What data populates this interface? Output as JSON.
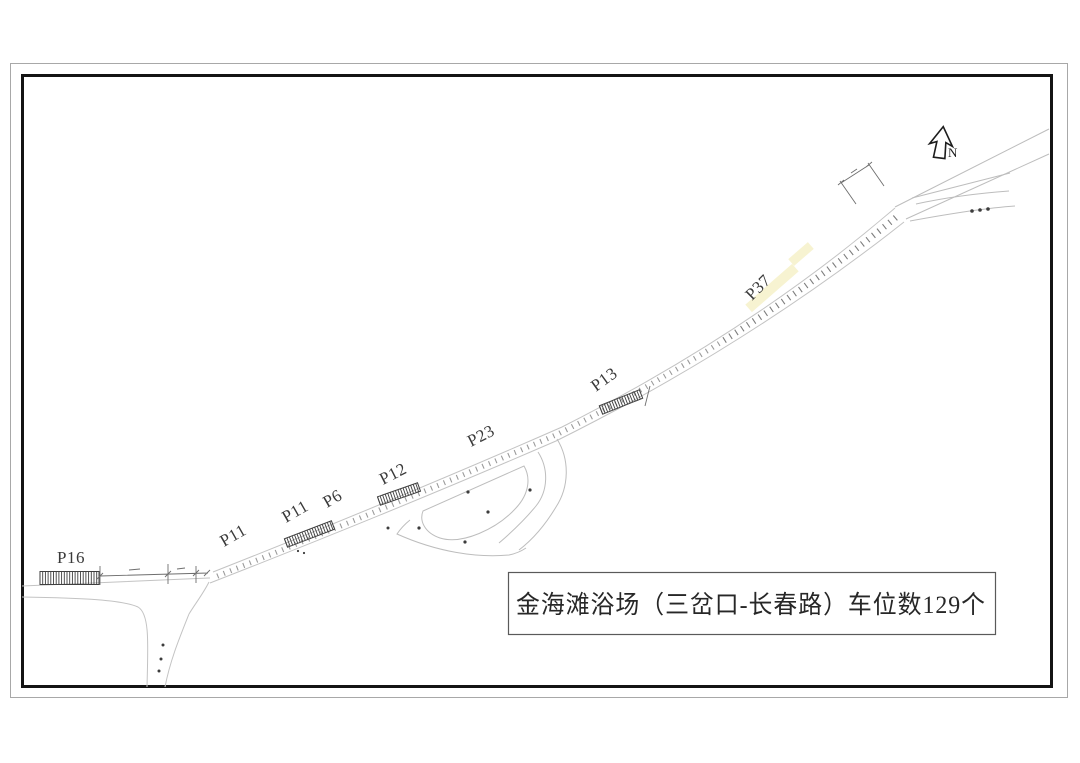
{
  "title_box": {
    "text": "金海滩浴场（三岔口-长春路）车位数129个"
  },
  "north_arrow": {
    "label": "N"
  },
  "parking_labels": [
    {
      "text": "P16",
      "x": 57,
      "y": 563,
      "rotate": 0
    },
    {
      "text": "P11",
      "x": 224,
      "y": 547,
      "rotate": -30
    },
    {
      "text": "P11",
      "x": 286,
      "y": 523,
      "rotate": -30
    },
    {
      "text": "P6",
      "x": 327,
      "y": 508,
      "rotate": -30
    },
    {
      "text": "P12",
      "x": 383,
      "y": 485,
      "rotate": -27
    },
    {
      "text": "P23",
      "x": 471,
      "y": 447,
      "rotate": -27
    },
    {
      "text": "P13",
      "x": 596,
      "y": 392,
      "rotate": -36
    },
    {
      "text": "P37",
      "x": 752,
      "y": 301,
      "rotate": -45
    }
  ],
  "colors": {
    "road": "#c3c3c3",
    "tick": "#9a9a9a",
    "tick_dark": "#7d7d7d",
    "parking_strip": "#3f3f3f",
    "frame_inner": "#141414",
    "frame_outer": "#a8a8a8",
    "highlight": "#f6f2cc",
    "text": "#272727"
  }
}
